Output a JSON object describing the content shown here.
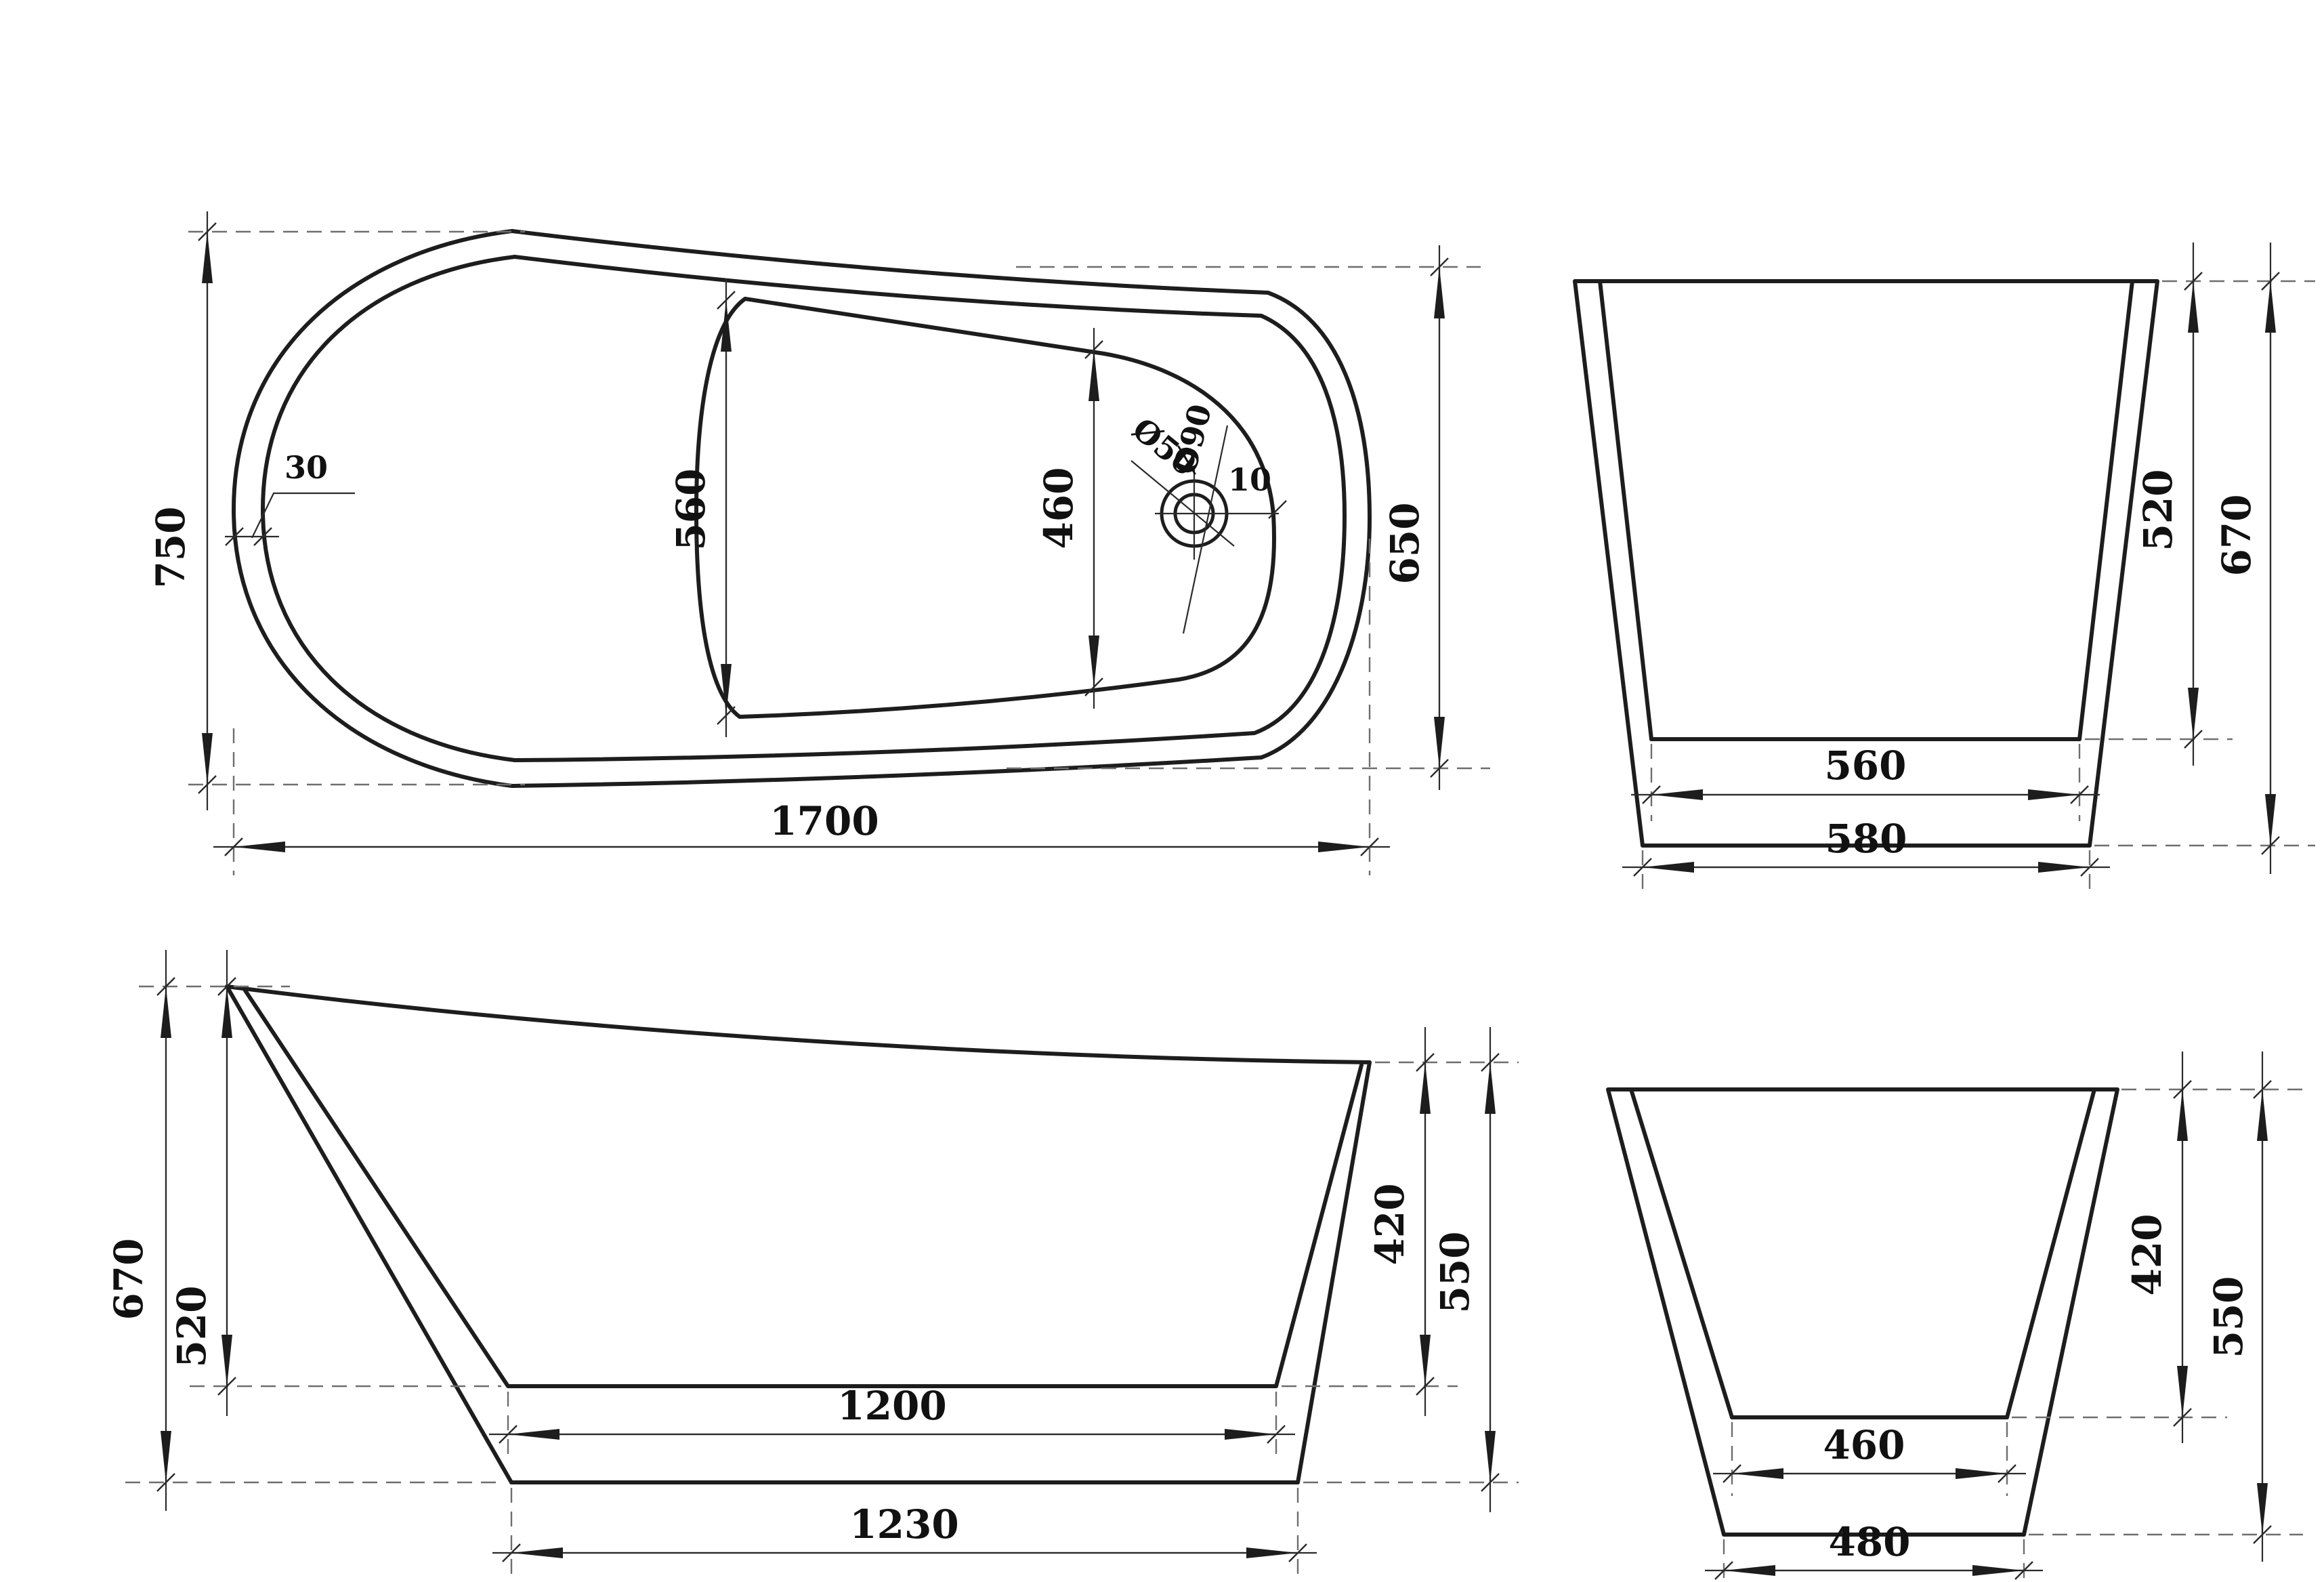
{
  "background": "#ffffff",
  "line_color": "#1d1d1d",
  "views": {
    "top_view": {
      "name": "plan view",
      "dims": {
        "overall_length": "1700",
        "width_left_end": "750",
        "width_right_end": "650",
        "basin_width_left": "560",
        "basin_width_right": "460",
        "rim_width": "30",
        "drain_edge_offset": "10",
        "drain_hole_diameter": "Ø50",
        "drain_recess_diameter": "Ø90"
      }
    },
    "head_end_view": {
      "name": "head end section",
      "dims": {
        "inner_depth": "520",
        "overall_height": "670",
        "bottom_inner_width": "560",
        "bottom_outer_width": "580"
      }
    },
    "side_view": {
      "name": "side elevation",
      "dims": {
        "overall_height": "670",
        "inner_depth": "520",
        "bottom_inner_length": "1200",
        "bottom_outer_length": "1230",
        "foot_inner_height": "420",
        "foot_overall_height": "550"
      }
    },
    "foot_end_view": {
      "name": "foot end section",
      "dims": {
        "inner_height": "420",
        "overall_height": "550",
        "bottom_inner_width": "460",
        "bottom_outer_width": "480"
      }
    }
  }
}
